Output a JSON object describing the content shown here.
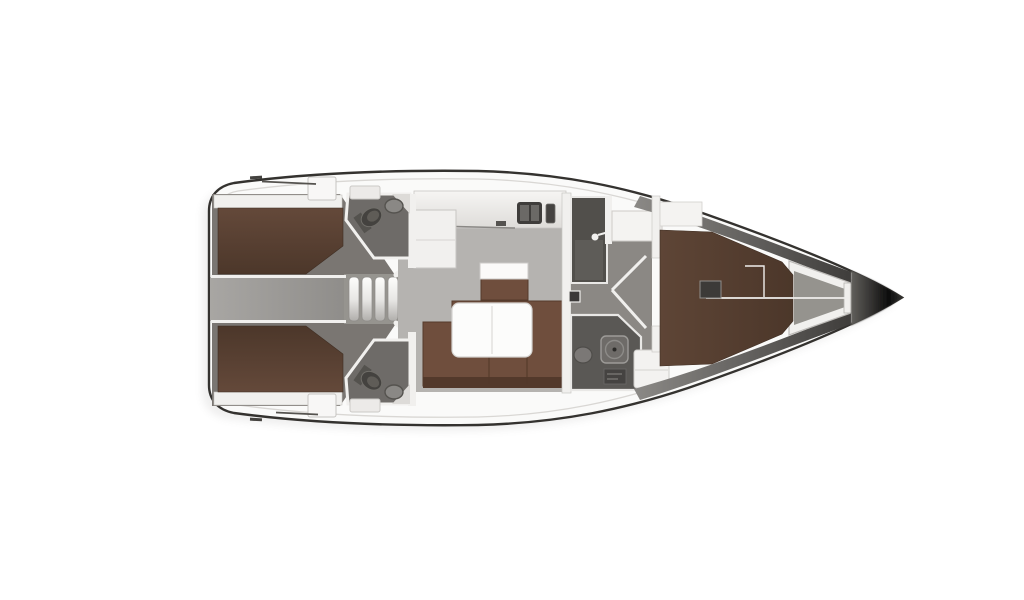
{
  "canvas": {
    "width": 1024,
    "height": 600,
    "background": "#ffffff"
  },
  "diagram": {
    "kind": "yacht-interior-floor-plan",
    "orientation": "bow-right",
    "visible_text": ""
  },
  "palette": {
    "background": "#ffffff",
    "hull_line": "#34322f",
    "hull_fill": "#fafaf9",
    "deck_edge": "#d9d7d4",
    "shade_mid": "#8b8986",
    "shade_dark": "#3f3d3b",
    "floor_saloon": "#b5b3b0",
    "floor_corridor": "#a09e9b",
    "floor_cabin": "#7a7672",
    "floor_passage": "#8b8884",
    "head_room": "#6e6b68",
    "head_dark": "#514f4b",
    "berth_brown": "#5e4536",
    "berth_dark": "#4c372a",
    "sofa_brown": "#6f4e3d",
    "sofa_dark": "#53392b",
    "fixture_dark": "#454341",
    "fixture_mid": "#6b6966",
    "wall_white": "#f1f0ee",
    "wall_stroke": "#c8c6c3",
    "table_white": "#fcfcfb",
    "bow_black": "#0c0c0c",
    "locker_floor": "#95938e"
  },
  "rooms": {
    "aft_cabin_port": {
      "label": "aft double cabin (port) with berth"
    },
    "aft_cabin_starboard": {
      "label": "aft double cabin (starboard) with berth"
    },
    "head_aft_port": {
      "label": "aft head with toilet and sink"
    },
    "head_aft_starboard": {
      "label": "aft head with toilet and sink"
    },
    "companionway": {
      "label": "companionway steps and corridor"
    },
    "galley": {
      "label": "galley with sink and stove"
    },
    "saloon": {
      "label": "saloon with U-settee, table and stool"
    },
    "shower_room": {
      "label": "midship shower compartment"
    },
    "head_forward": {
      "label": "forward head with shower, sink and vanity"
    },
    "cabin_forward": {
      "label": "forward cabin with V-berth"
    },
    "bow_locker": {
      "label": "anchor locker"
    }
  },
  "fixtures": [
    "toilet-icon",
    "sink-icon",
    "shower-icon",
    "stove-icon",
    "galley-sink-icon",
    "door-swing-icon",
    "door-handle-icon",
    "steps-icon",
    "table",
    "settee",
    "berth",
    "nightstand",
    "bow-cone"
  ]
}
